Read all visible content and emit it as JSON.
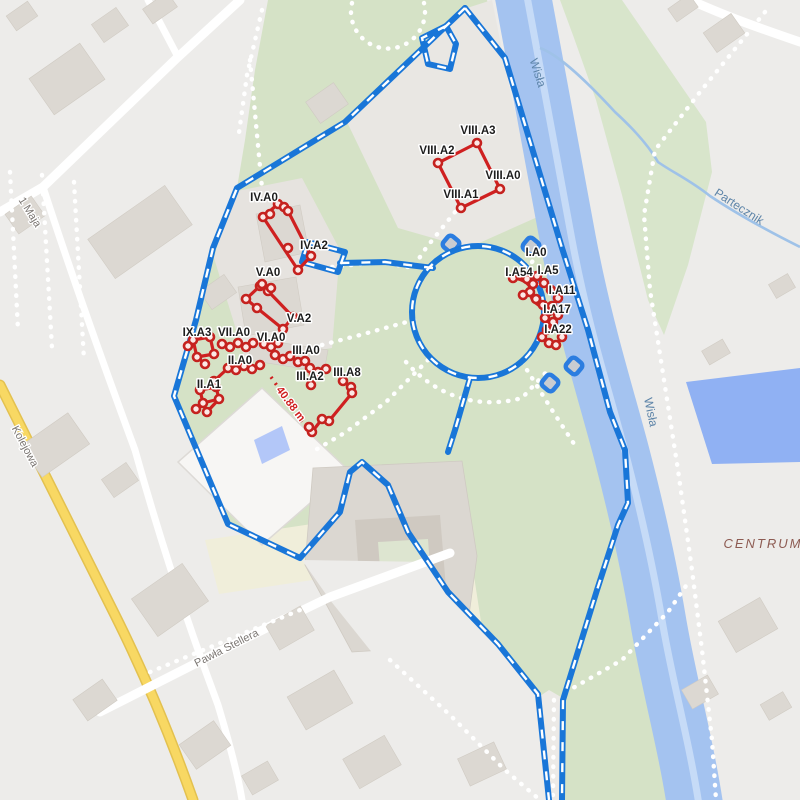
{
  "labels": {
    "streets": [
      "1 Maja",
      "Kolejowa",
      "Pawła Stellera"
    ],
    "water": [
      "Wisła",
      "Wisła",
      "Partecznik"
    ],
    "district": "CENTRUM",
    "sites": [
      "IV.A0",
      "IV.A2",
      "V.A0",
      "V.A2",
      "VI.A0",
      "IX.A3",
      "VII.A0",
      "II.A0",
      "II.A1",
      "III.A0",
      "III.A2",
      "III.A8",
      "VIII.A3",
      "VIII.A2",
      "VIII.A0",
      "VIII.A1",
      "I.A0",
      "I.A54",
      "I.A5",
      "I.A11",
      "I.A17",
      "I.A22"
    ]
  },
  "overlay": {
    "measurement": "40.88 m"
  },
  "colors": {
    "site_red": "#cf2020",
    "boundary_blue": "#1976d8",
    "river": "#a4c3f0",
    "river_stripe": "#c6dbf7",
    "basin": "#90b1f3",
    "pond": "#b3c7f8",
    "stream": "#9fc2e8",
    "park_green": "#d5e2c6",
    "park_green_east": "#d8e5cb",
    "city_gray": "#edecea",
    "building_gray": "#dcd8d2",
    "road_yellow": "#f8d863",
    "field_yellow": "#f0eeda"
  }
}
